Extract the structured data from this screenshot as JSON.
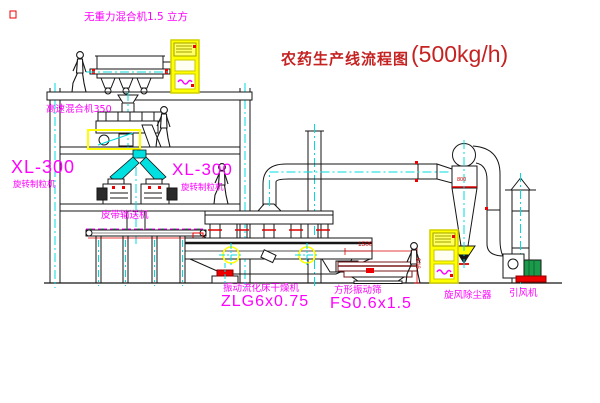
{
  "title": {
    "name": "农药生产线流程图",
    "capacity": "(500kg/h)"
  },
  "labels": {
    "gravity_mixer": "无重力混合机1.5 立方",
    "high_speed_mixer": "高速混合机350",
    "granulator_left": {
      "model": "XL-300",
      "name": "旋转制粒机"
    },
    "granulator_right": {
      "model": "XL-300",
      "name": "旋转制粒机"
    },
    "belt_conveyor": "皮带输送机",
    "fluid_bed_dryer": {
      "name": "振动流化床干燥机",
      "model": "ZLG6x0.75"
    },
    "vibrating_screen": {
      "name": "方形振动筛",
      "model": "FS0.6x1.5"
    },
    "cyclone": "旋风除尘器",
    "fan": "引风机"
  },
  "dimensions": {
    "cyclone_diameter": "800",
    "screen_length": "1500",
    "screen_height": "946"
  },
  "colors": {
    "label_magenta": "#ff00ff",
    "title_red": "#c52222",
    "centerline_cyan": "#00dcdc",
    "highlight_yellow": "#ffff00",
    "dimension_red": "#dd0000",
    "fan_motor_green": "#1a9a4a"
  }
}
